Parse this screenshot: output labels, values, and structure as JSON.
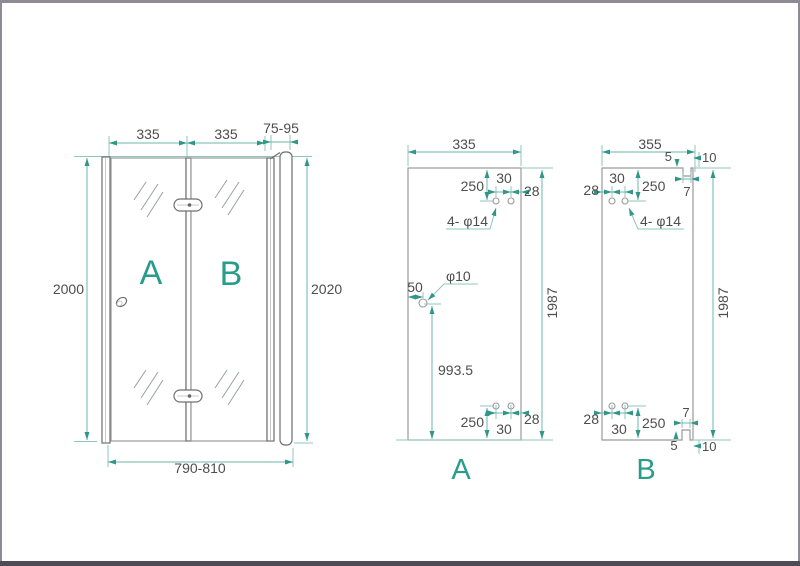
{
  "colors": {
    "dim": "#6cb5a9",
    "ext": "#8cc7bd",
    "arrow": "#2f9688",
    "text": "#4d4d4d",
    "label": "#2a9c8b",
    "outline": "#999999",
    "frame": "#6f6f6f",
    "border": "#8f8b95",
    "bottombar": "#4e4a56"
  },
  "front_view": {
    "width_panel_a": "335",
    "width_panel_b": "335",
    "wall_profile_range": "75-95",
    "height_left": "2000",
    "height_right": "2020",
    "total_width_range": "790-810",
    "panel_a_label": "A",
    "panel_b_label": "B"
  },
  "panel_a": {
    "label": "A",
    "width": "335",
    "height": "1987",
    "hinge_hole_offset_top": "250",
    "hinge_hole_spacing_top": "30",
    "hinge_hole_edge_top": "28",
    "hinge_hole_callout": "4- φ14",
    "knob_hole_callout": "φ10",
    "knob_hole_edge": "50",
    "knob_hole_height": "993.5",
    "hinge_hole_offset_bottom": "250",
    "hinge_hole_spacing_bottom": "30",
    "hinge_hole_edge_bottom": "28"
  },
  "panel_b": {
    "label": "B",
    "width": "355",
    "height": "1987",
    "notch_width_top": "5",
    "notch_edge_top": "10",
    "notch_depth_top": "7",
    "hinge_hole_edge_top": "28",
    "hinge_hole_spacing_top": "30",
    "hinge_hole_offset_top": "250",
    "hinge_hole_callout": "4- φ14",
    "hinge_hole_edge_bottom": "28",
    "hinge_hole_spacing_bottom": "30",
    "hinge_hole_offset_bottom": "250",
    "notch_depth_bottom": "7",
    "notch_width_bottom": "5",
    "notch_edge_bottom": "10"
  }
}
